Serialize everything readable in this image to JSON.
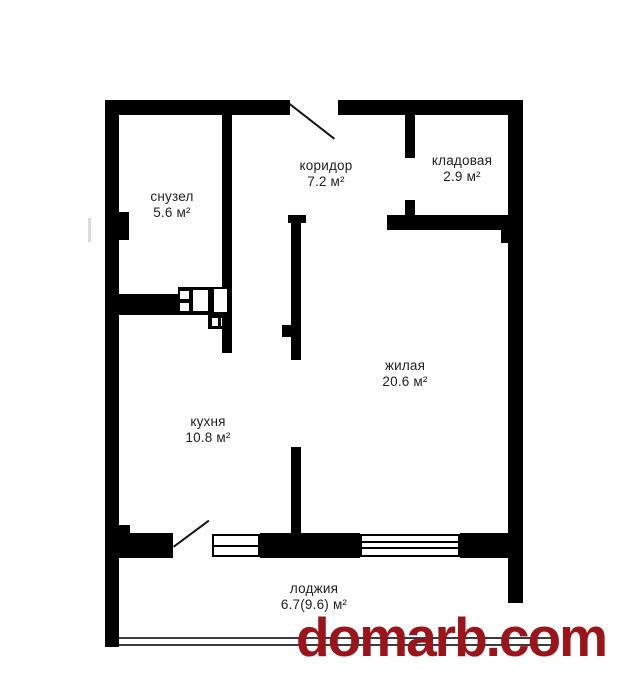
{
  "plan": {
    "rooms": [
      {
        "name": "снузел",
        "area": "5.6 м²"
      },
      {
        "name": "коридор",
        "area": "7.2 м²"
      },
      {
        "name": "кладовая",
        "area": "2.9 м²"
      },
      {
        "name": "жилая",
        "area": "20.6 м²"
      },
      {
        "name": "кухня",
        "area": "10.8 м²"
      },
      {
        "name": "лоджия",
        "area": "6.7(9.6) м²"
      }
    ],
    "colors": {
      "wall": "#000000",
      "background": "#ffffff",
      "watermark": "#9a1419"
    }
  },
  "watermark": {
    "text": "domarb.com"
  }
}
